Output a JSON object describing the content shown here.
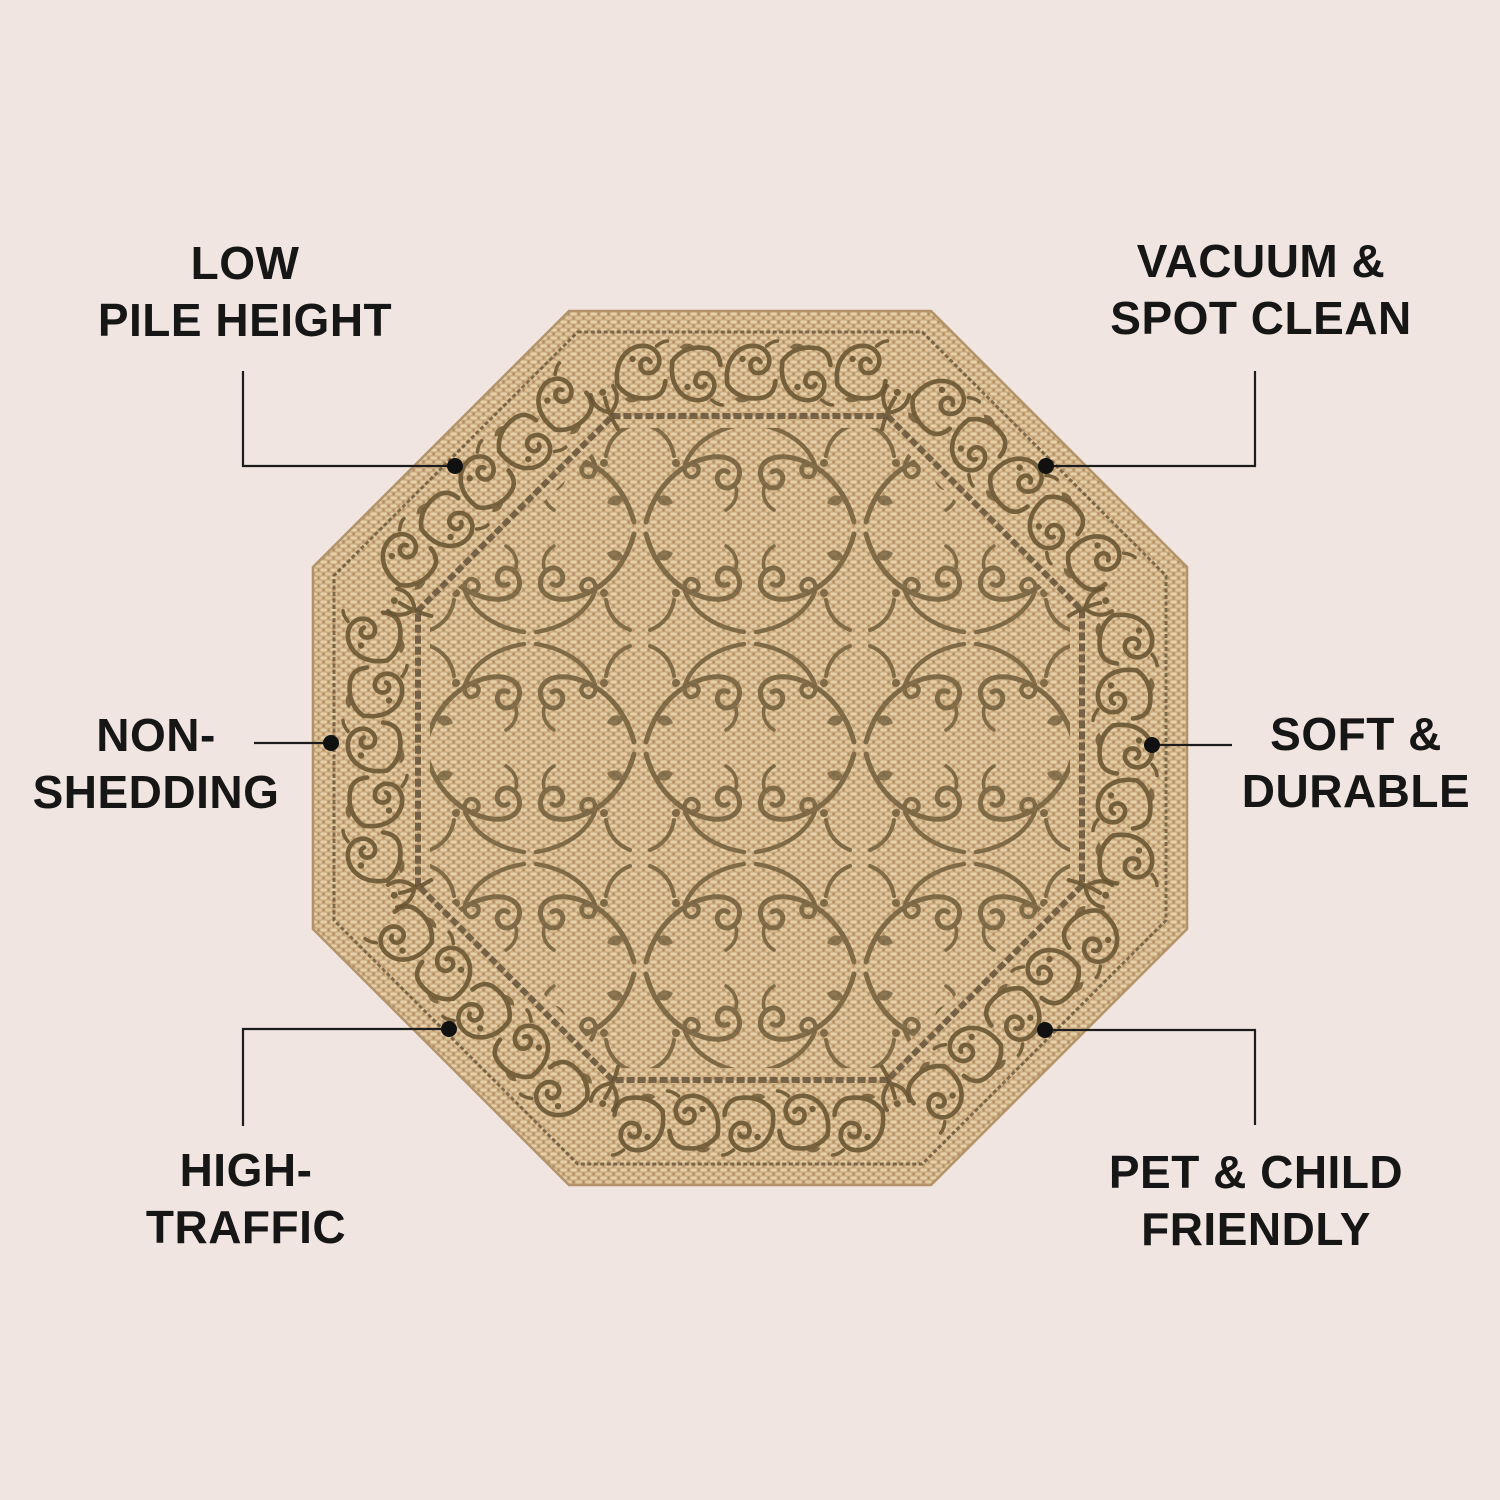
{
  "features": {
    "low_pile": {
      "line1": "LOW",
      "line2": "PILE HEIGHT"
    },
    "vacuum": {
      "line1": "VACUUM &",
      "line2": "SPOT CLEAN"
    },
    "non_shedding": {
      "line1": "NON-",
      "line2": "SHEDDING"
    },
    "soft_durable": {
      "line1": "SOFT &",
      "line2": "DURABLE"
    },
    "high_traffic": {
      "line1": "HIGH-",
      "line2": "TRAFFIC"
    },
    "pet_child": {
      "line1": "PET & CHILD",
      "line2": "FRIENDLY"
    }
  },
  "colors": {
    "page_background": "#f0e5e0",
    "label_text": "#161616",
    "callout_line": "#1c1c1c",
    "callout_dot": "#111111",
    "rug_tan_light": "#e6d1a9",
    "rug_tan_mid": "#d9bd96",
    "rug_tan_dark": "#b08d60",
    "rug_scroll_brown": "#66522f",
    "rug_line_brown": "#5f4c33"
  }
}
